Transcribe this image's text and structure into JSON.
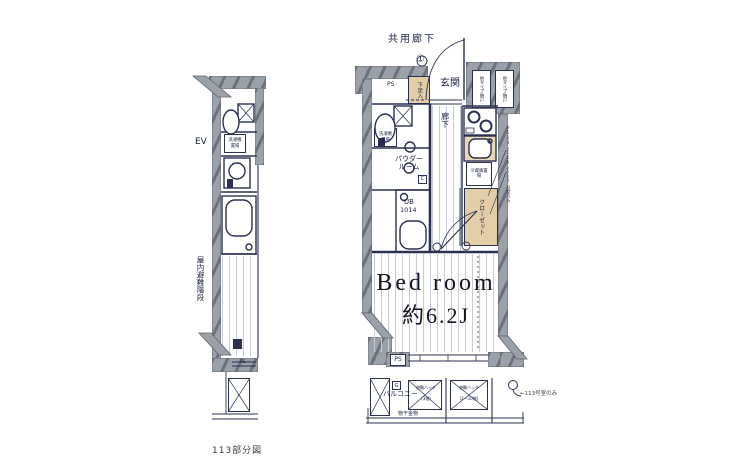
{
  "caption": "113部分図",
  "left_plan": {
    "ev_label": "EV",
    "stairs_label": "屋内避難階段",
    "washer_label": "洗濯機置場",
    "ps_label": "PS"
  },
  "main_plan": {
    "common_corridor": "共用廊下",
    "entry_mark": "①",
    "genkan": "玄関",
    "ps_top": "PS",
    "shoe_box": "下足入",
    "storage_left": "他タイプ納戸",
    "storage_right": "他タイプ納戸",
    "hallway": "廊下",
    "washer": "洗濯機置場",
    "powder_room": "パウダールーム",
    "c_mark": "C",
    "unit_bath": "UB",
    "unit_bath_size": "1014",
    "fridge": "冷蔵庫置場",
    "closet": "クローゼット",
    "bedroom_name": "Bed room",
    "bedroom_size": "約6.2J",
    "side_note": "※113・115・117号室のみ",
    "balcony": "バルコニー",
    "g_mark": "G",
    "ps_bottom": "PS",
    "hatch_left_line1": "避難ハッチ",
    "hatch_left_line2": "(3階)",
    "hatch_right_line1": "避難ハッチ",
    "hatch_right_line2": "(2〜10階)",
    "laundry_fitting": "物干金物",
    "bottom_note": "←113号室のみ"
  }
}
